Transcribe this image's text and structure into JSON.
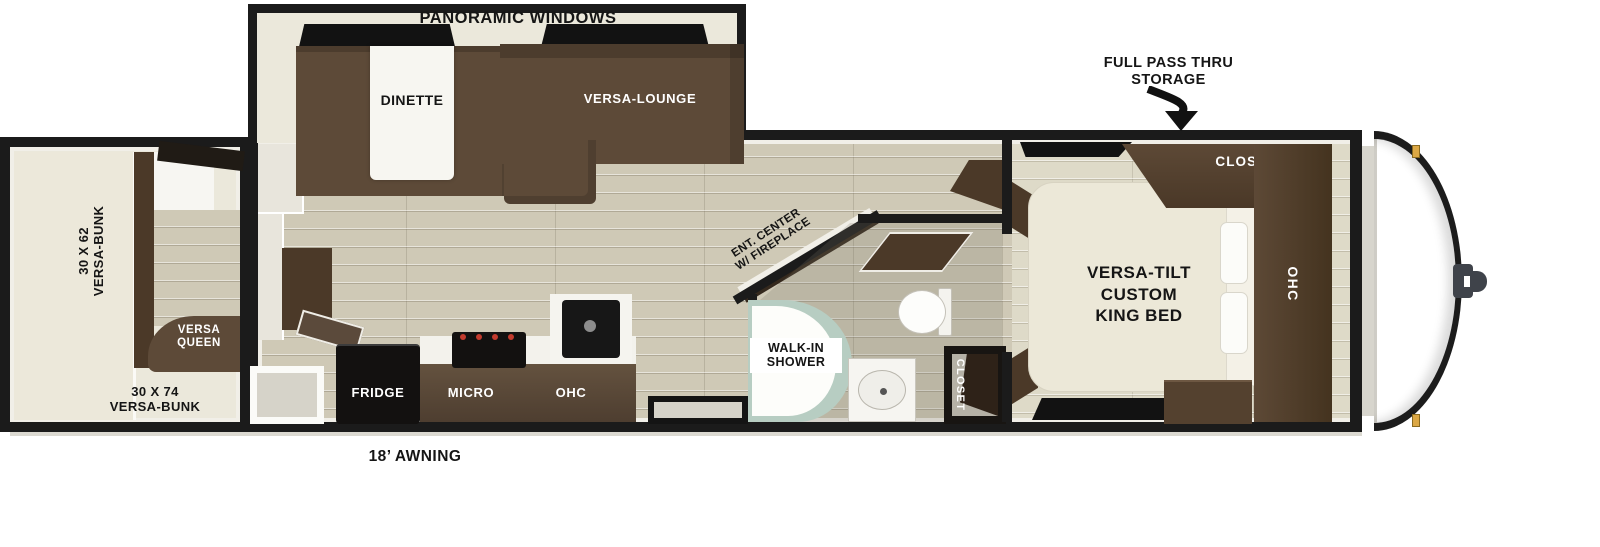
{
  "colors": {
    "wall": "#1b1b1b",
    "floor_wood": "#cfc9b6",
    "floor_bedroom": "#dedac8",
    "cream": "#ebe8db",
    "sofa_brown": "#5d4a38",
    "cabinet_brown": "#4b3928",
    "counter_brown": "#5b4a3b",
    "appliance_black": "#131110",
    "shower_teal": "#b7cdc2",
    "burner_red": "#c23b2d",
    "marker_amber": "#dca845",
    "text_dark": "#151515",
    "text_light": "#ffffff"
  },
  "annotations": {
    "panoramic_windows": "PANORAMIC WINDOWS",
    "storage_line1": "FULL PASS THRU",
    "storage_line2": "STORAGE",
    "awning": "18’ AWNING"
  },
  "slideout": {
    "dinette": "DINETTE",
    "lounge": "VERSA-LOUNGE"
  },
  "bunk_room": {
    "bunk62_line1": "30 X 62",
    "bunk62_line2": "VERSA-BUNK",
    "queen_line1": "VERSA",
    "queen_line2": "QUEEN",
    "bunk74_line1": "30 X 74",
    "bunk74_line2": "VERSA-BUNK"
  },
  "kitchen": {
    "fridge": "FRIDGE",
    "micro": "MICRO",
    "ohc": "OHC"
  },
  "living": {
    "ent_line1": "ENT. CENTER",
    "ent_line2": "W/ FIREPLACE"
  },
  "bathroom": {
    "shower_line1": "WALK-IN",
    "shower_line2": "SHOWER",
    "closet": "CLOSET"
  },
  "bedroom": {
    "closet": "CLOSET",
    "ohc": "OHC",
    "bed_line1": "VERSA-TILT",
    "bed_line2": "CUSTOM",
    "bed_line3": "KING BED"
  }
}
